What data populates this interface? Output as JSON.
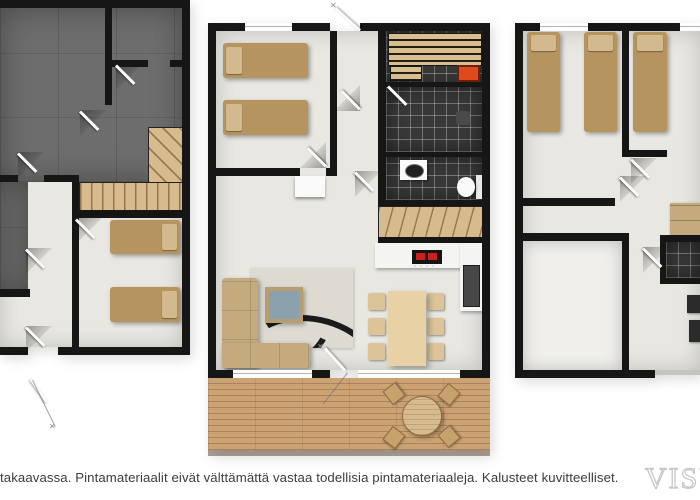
{
  "image": {
    "type": "floor-plan-rendering",
    "style": "3d-top-down",
    "panel_count": 3
  },
  "floorplans": [
    {
      "id": "basement",
      "position": "left",
      "edge_cut": "left",
      "rooms": [
        "concrete-technical-room",
        "concrete-storage-rooms",
        "hallway",
        "bedroom-with-two-beds",
        "staircase"
      ]
    },
    {
      "id": "main-floor",
      "position": "center",
      "rooms": [
        "bedroom-with-two-beds",
        "entry-corridor",
        "sauna",
        "shower-room",
        "wc",
        "staircase",
        "kitchen",
        "dining-area",
        "living-room",
        "terrace-deck"
      ]
    },
    {
      "id": "upper-floor",
      "position": "right",
      "edge_cut": "right",
      "rooms": [
        "bedroom-with-two-beds",
        "bedroom-with-bed",
        "hallway",
        "large-room",
        "bathroom"
      ]
    }
  ],
  "caption": {
    "text": "takaavassa. Pintamateriaalit eivät välttämättä vastaa todellisia pintamateriaaleja. Kalusteet kuvitteelliset."
  },
  "watermark": {
    "text": "Visu"
  },
  "colors": {
    "background": "#ffffff",
    "wall": "#161616",
    "concreteFloor": "#6d6d6d",
    "lightFloor": "#e9e7e1",
    "whiteFloor": "#f0efeb",
    "stairWood": "#d8bb8c",
    "deckWood": "#cda273",
    "bed": "#b5945f",
    "pillow": "#d2ba8e",
    "sofa": "#c5aa7e",
    "diningWood": "#e7d1a5",
    "chairWood": "#dcc498",
    "darkTile": "#383838",
    "saunaBench": "#d9be90",
    "stove": "#e0491d",
    "rug": "#dcdad1",
    "rugStripe": "#1b1b1b",
    "tableGlass": "#8ba1ad",
    "counter": "#f4f4f2",
    "cooktop": "#141414",
    "cooktopElement": "#cc1f1f",
    "captionColor": "#3c3c3c",
    "watermarkStroke": "#c6c6c6"
  }
}
